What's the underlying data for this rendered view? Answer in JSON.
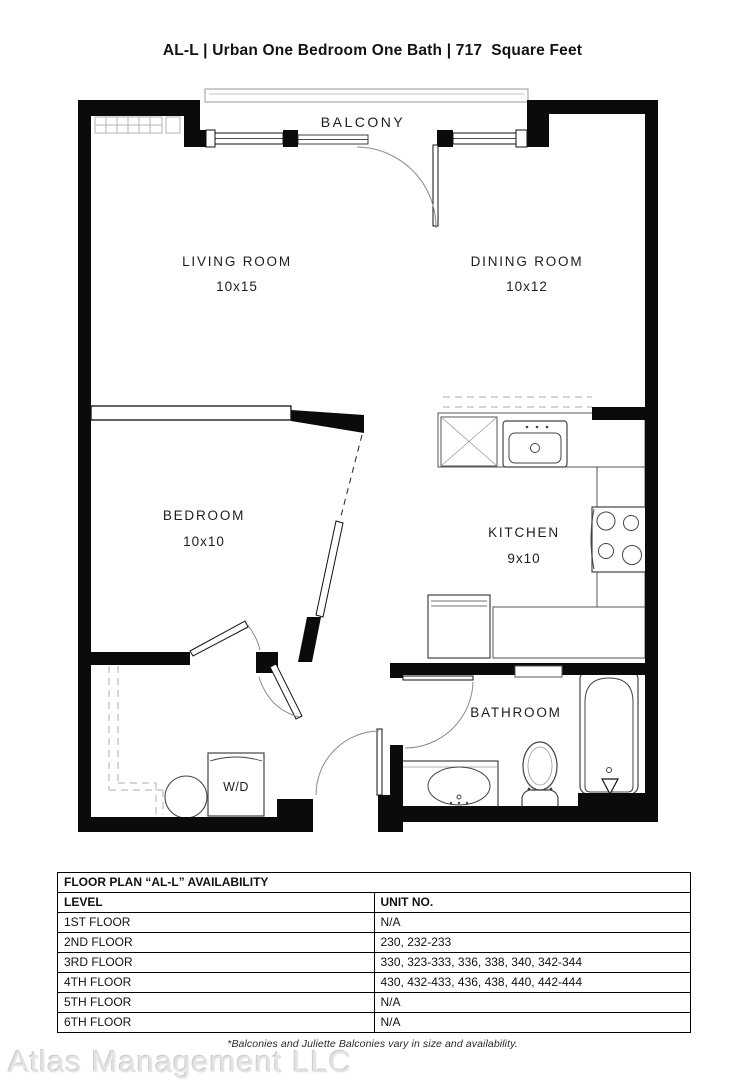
{
  "page": {
    "title": "AL-L | Urban One Bedroom One Bath | 717  Square Feet"
  },
  "floor_plan": {
    "balcony_label": "BALCONY",
    "living_room": {
      "name": "LIVING ROOM",
      "dims": "10x15"
    },
    "dining_room": {
      "name": "DINING ROOM",
      "dims": "10x12"
    },
    "bedroom": {
      "name": "BEDROOM",
      "dims": "10x10"
    },
    "kitchen": {
      "name": "KITCHEN",
      "dims": "9x10"
    },
    "bathroom": {
      "name": "BATHROOM"
    },
    "washer_dryer": {
      "label": "W/D"
    }
  },
  "availability_table": {
    "title": "FLOOR PLAN “AL-L” AVAILABILITY",
    "columns": {
      "level": "LEVEL",
      "unit": "UNIT NO."
    },
    "rows": [
      {
        "level": "1ST FLOOR",
        "units": "N/A"
      },
      {
        "level": "2ND FLOOR",
        "units": "230, 232-233"
      },
      {
        "level": "3RD FLOOR",
        "units": "330, 323-333, 336, 338, 340, 342-344"
      },
      {
        "level": "4TH FLOOR",
        "units": "430, 432-433, 436, 438, 440, 442-444"
      },
      {
        "level": "5TH FLOOR",
        "units": "N/A"
      },
      {
        "level": "6TH FLOOR",
        "units": "N/A"
      }
    ]
  },
  "footnote": "*Balconies and Juliette Balconies vary in size and availability.",
  "watermark": "Atlas Management LLC",
  "colors": {
    "wall": "#0b0b0b",
    "fixture_line": "#444444",
    "counter_line": "#555555",
    "arc_line": "#8a8a8a",
    "dash_line": "#aaaaaa",
    "text": "#1d1d1d"
  }
}
